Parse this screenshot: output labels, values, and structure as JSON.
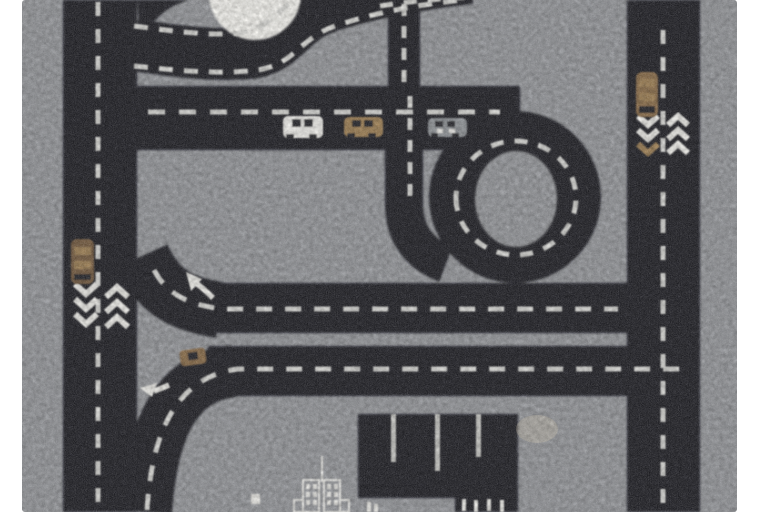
{
  "photo": {
    "subject": "Grey children's play rug with black road-map pattern, viewed from above on a white background",
    "visible_objects": "roads with dashed lane lines, roundabout circle, highway loop, parking bays, toy cars, lane chevrons, turn arrows, white city-building outline"
  },
  "colors": {
    "background": "#ffffff",
    "rug": "#94969a",
    "road": "#15181d",
    "dash": "#d9d9d5",
    "marking": "#f2f1ec",
    "white_circle": "#f8f7f2",
    "car_white": "#f4f3ef",
    "car_gray": "#8f9397",
    "tan": "#9d7d50",
    "tan_dark": "#876743",
    "brown": "#6f5538",
    "stripe": "#c7c7c3",
    "stain": "#e6d8b8",
    "window": "#1b1e23"
  },
  "scene": {
    "roads": {
      "left_vertical": "two-lane road, dashed centre line",
      "right_vertical": "two-lane road, dashed centre line",
      "main_horizontal": "highway with three cars",
      "top_curve": "ring road around white circle",
      "middle_horizontal": "road with merge arrow",
      "lower_horizontal": "road with small car and left arrow",
      "loop": "highway loop (6-shape) with dashed ring"
    },
    "cars": [
      {
        "id": "car-white",
        "color": "white",
        "location": "main horizontal road"
      },
      {
        "id": "car-tan",
        "color": "tan",
        "location": "main horizontal road"
      },
      {
        "id": "car-gray",
        "color": "gray",
        "location": "main horizontal road"
      },
      {
        "id": "car-brown-left",
        "color": "brown",
        "location": "left vertical road"
      },
      {
        "id": "car-tan-right",
        "color": "tan",
        "location": "right vertical road"
      },
      {
        "id": "car-tan-small",
        "color": "tan",
        "location": "lower horizontal road"
      }
    ],
    "markings": {
      "chevrons_left_road": "3 down + 3 up white chevrons",
      "chevrons_right_road": "2 white + 1 tan down, 3 up white chevrons",
      "arrows": "white merge arrow (up-left), white turn arrow (down-left)",
      "parking": "black parking lot with 3 light bay stripes and 4 small ticks"
    },
    "building": "white outlined twin-tower building with antenna and window grid"
  }
}
